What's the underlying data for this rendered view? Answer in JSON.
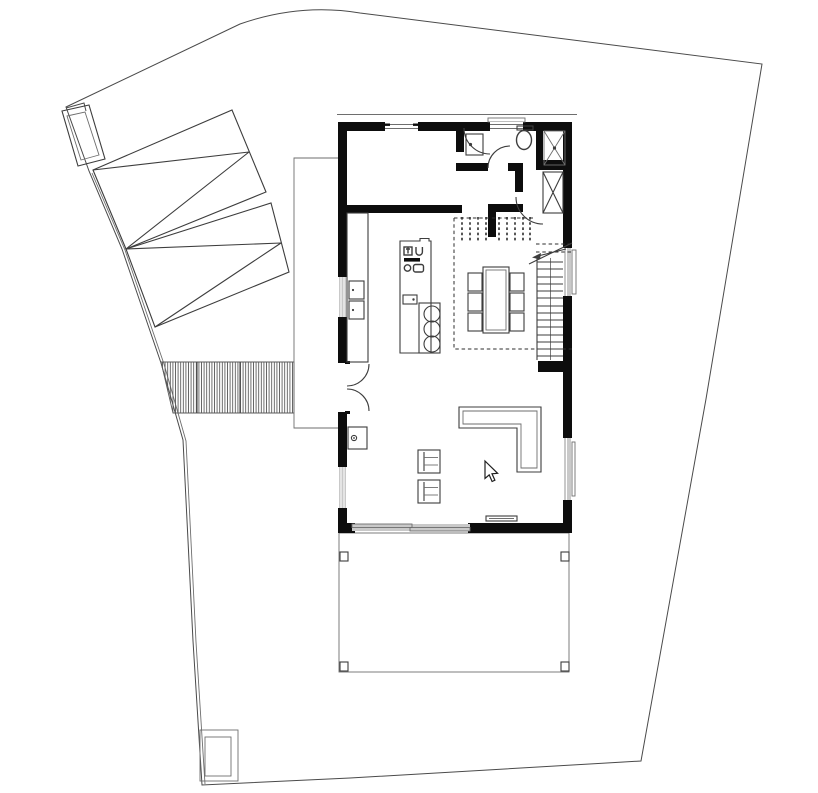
{
  "document": {
    "kind": "architectural-site-and-floor-plan",
    "background": "#ffffff"
  },
  "colors": {
    "paper": "#ffffff",
    "wall": "#0d0d0d",
    "line": "#3d3d3d",
    "thin": "#6e6e6e",
    "boundary": "#4a4a4a",
    "window": "#c9c9c9",
    "hatch": "#5a5a5a",
    "dash": "#2e2e2e",
    "cursor_fill": "#ffffff",
    "cursor_edge": "#1f1f1f"
  },
  "cursor": {
    "icon": "mouse-pointer-icon",
    "x": 485,
    "y": 461
  },
  "plan": {
    "site_elements": [
      "property-boundary",
      "garage-roof",
      "chimney",
      "gravel-walkway",
      "side-platform",
      "terrace",
      "terrace-posts",
      "garden-shed"
    ],
    "rooms": [
      "storage-room",
      "wc",
      "shower",
      "hallway",
      "kitchen",
      "dining-area",
      "living-area",
      "stairs"
    ],
    "furniture_counts": {
      "dining_chairs": 6,
      "bar_stools": 3,
      "lounge_chairs": 2,
      "sofas": 1,
      "terrace_posts": 4
    },
    "fixtures": [
      "kitchen-island",
      "kitchen-counter",
      "kitchen-sink",
      "dining-table",
      "l-sofa",
      "fireplace-stove",
      "wc-sink",
      "toilet",
      "shower-tray",
      "wardrobe",
      "sliding-door",
      "french-door",
      "stair-run"
    ]
  }
}
